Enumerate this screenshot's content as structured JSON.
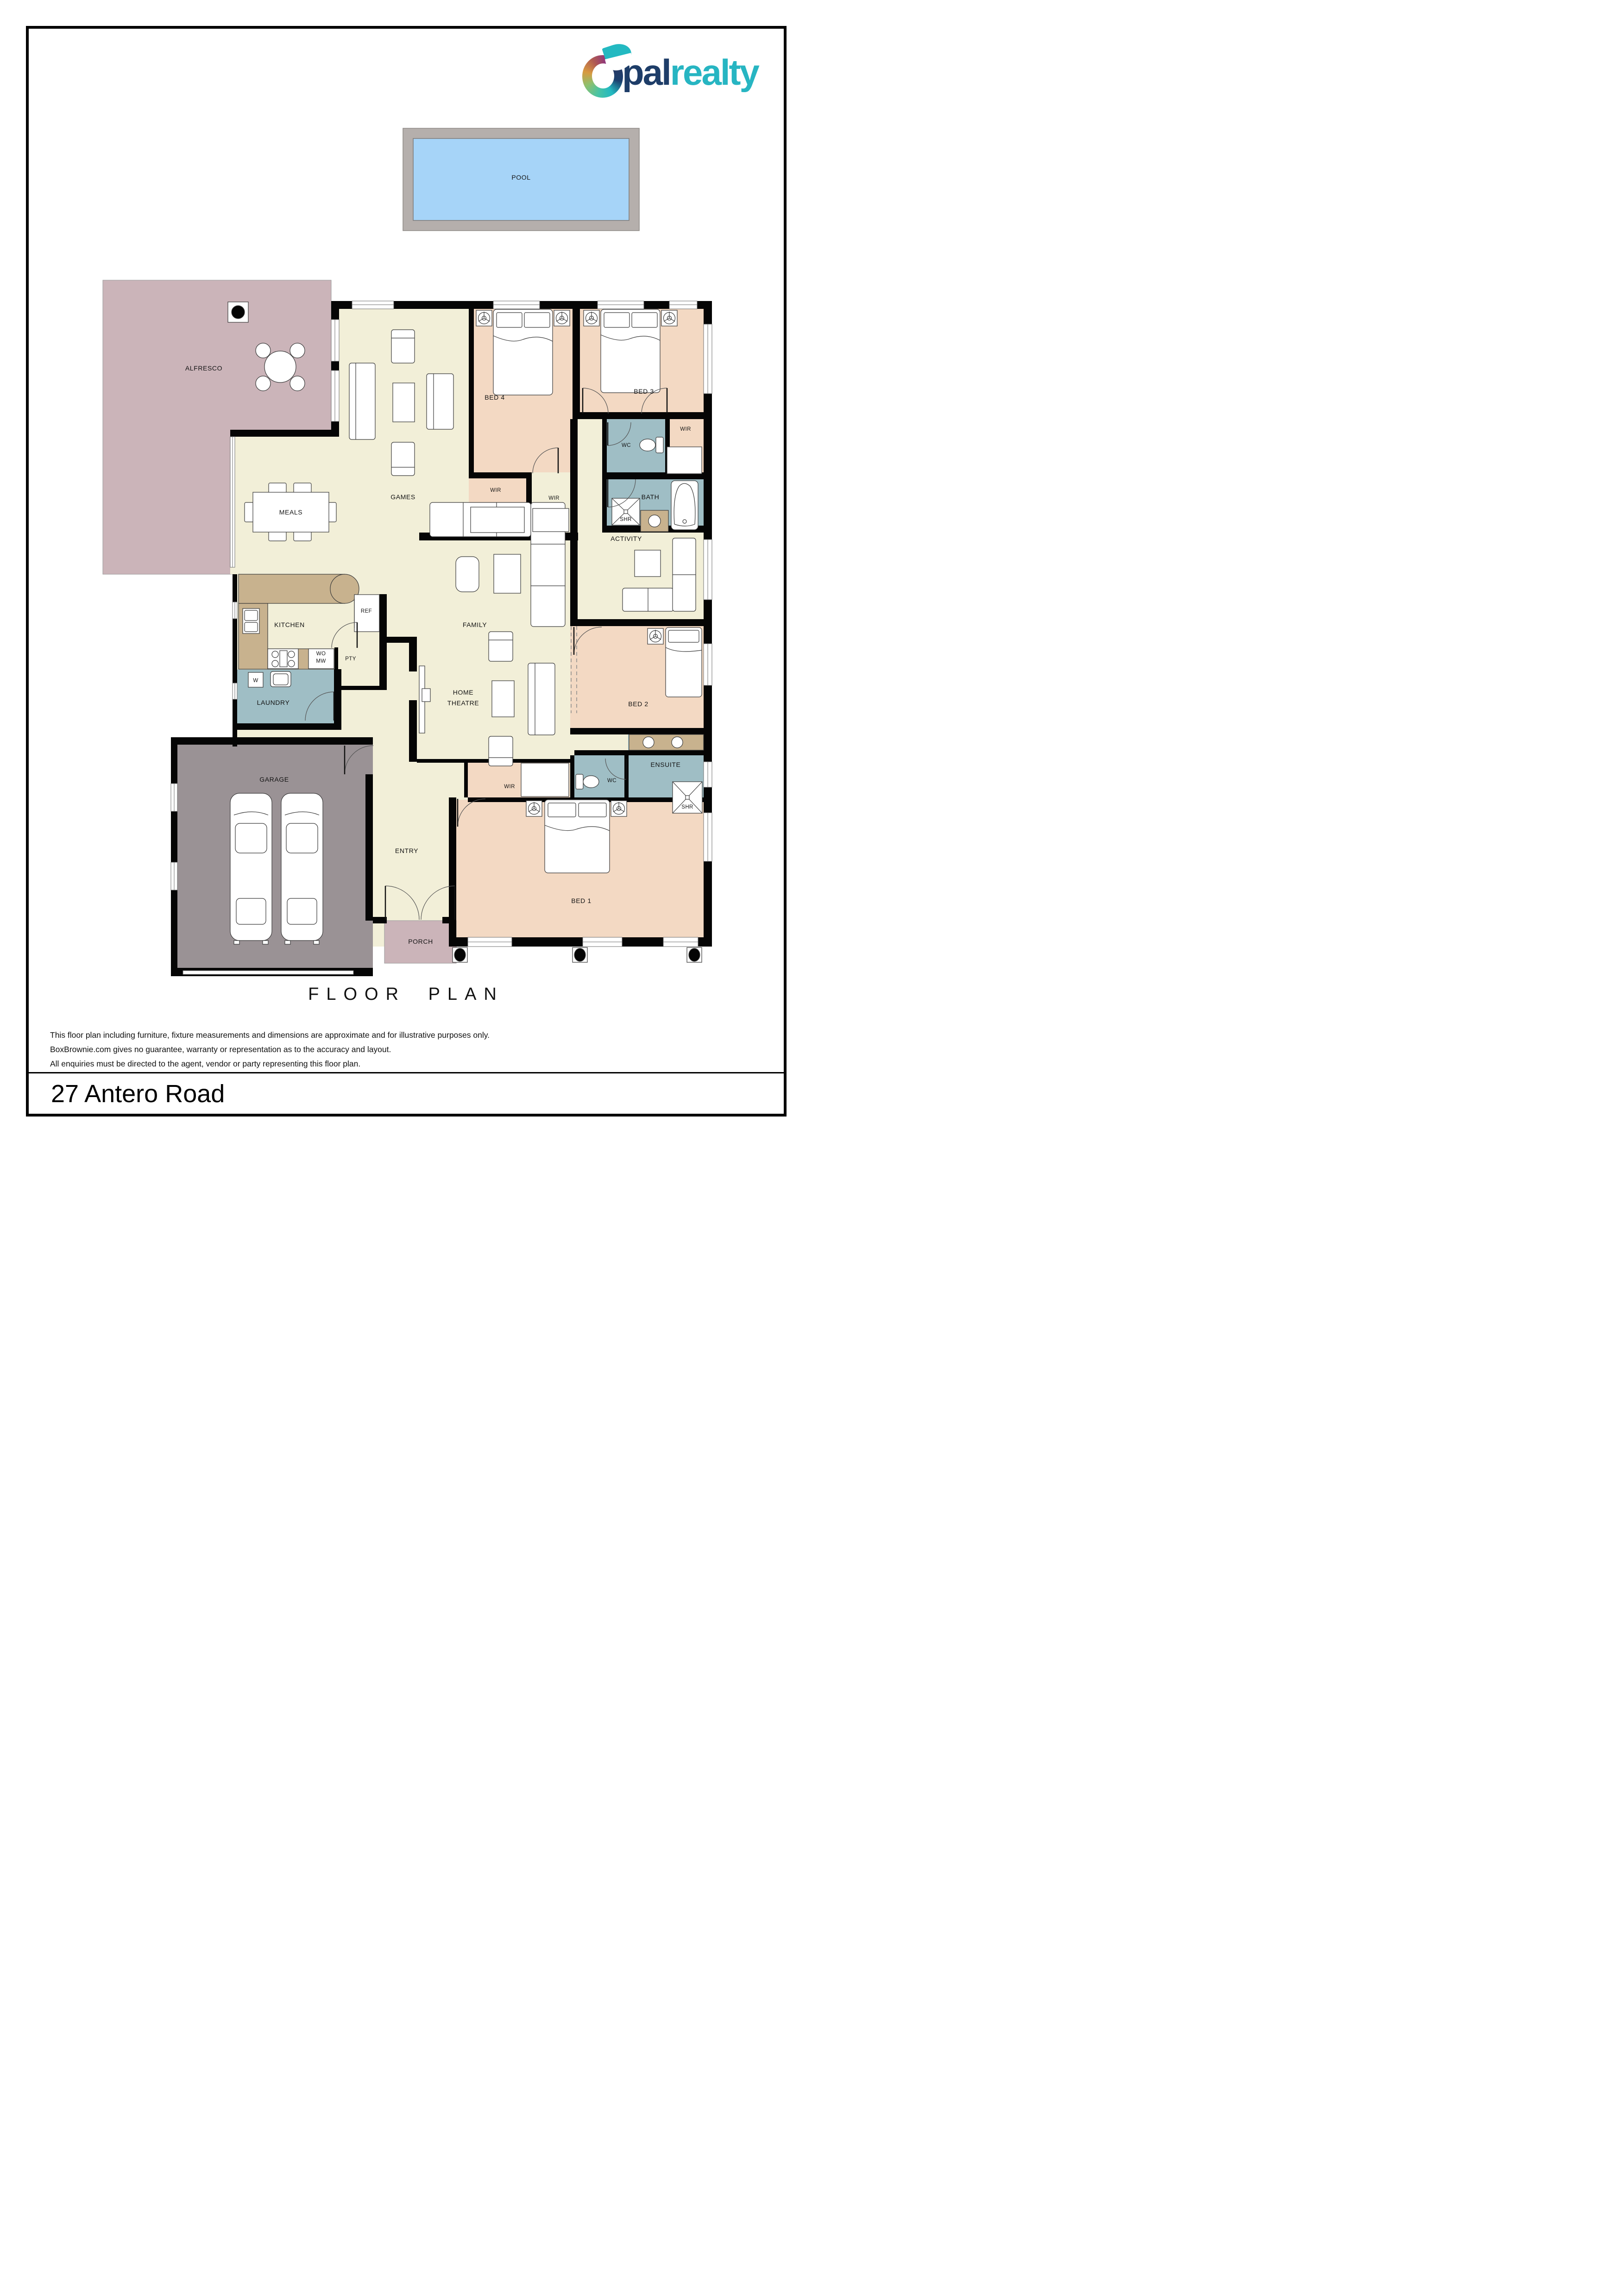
{
  "logo": {
    "brand_part1": "pal",
    "brand_part2": "realty",
    "brand_full": "Opalrealty",
    "accent_teal": "#27b5c2",
    "accent_navy": "#1e3d68"
  },
  "floor_plan": {
    "title": "FLOOR PLAN",
    "labels": {
      "pool": "POOL",
      "alfresco": "ALFRESCO",
      "games": "GAMES",
      "meals": "MEALS",
      "bed4": "BED 4",
      "bed3": "BED 3",
      "wir_bed4": "WIR",
      "wir_hall": "WIR",
      "wc_top": "WC",
      "wir_bed3": "WIR",
      "bath": "BATH",
      "shr_bath": "SHR",
      "activity": "ACTIVITY",
      "family": "FAMILY",
      "kitchen": "KITCHEN",
      "ref": "REF",
      "pty": "PTY",
      "wo_line1": "WO",
      "wo_line2": "MW",
      "washer": "W",
      "laundry": "LAUNDRY",
      "home_theatre_line1": "HOME",
      "home_theatre_line2": "THEATRE",
      "bed2": "BED 2",
      "wir_bed1": "WIR",
      "wc_bed1": "WC",
      "ensuite": "ENSUITE",
      "shr_ensuite": "SHR",
      "garage": "GARAGE",
      "entry": "ENTRY",
      "porch": "PORCH",
      "bed1": "BED 1"
    },
    "colors": {
      "walls": "#050505",
      "living_cream": "#F2EFD8",
      "bedroom_peach": "#F3D9C3",
      "wet_blue": "#9FBEC5",
      "outdoor_mauve": "#CBB4B9",
      "garage_grey": "#9A9295",
      "bench_marble": "#C8B28E",
      "pool_water": "#A6D4F8",
      "pool_deck": "#B5AFAC"
    }
  },
  "disclaimer": {
    "line1": "This floor plan including furniture, fixture measurements and dimensions are approximate and for illustrative purposes only.",
    "line2": "BoxBrownie.com gives no guarantee, warranty or representation as to the accuracy and layout.",
    "line3": "All enquiries must be directed to the agent, vendor or party representing this floor plan."
  },
  "address": "27 Antero Road"
}
